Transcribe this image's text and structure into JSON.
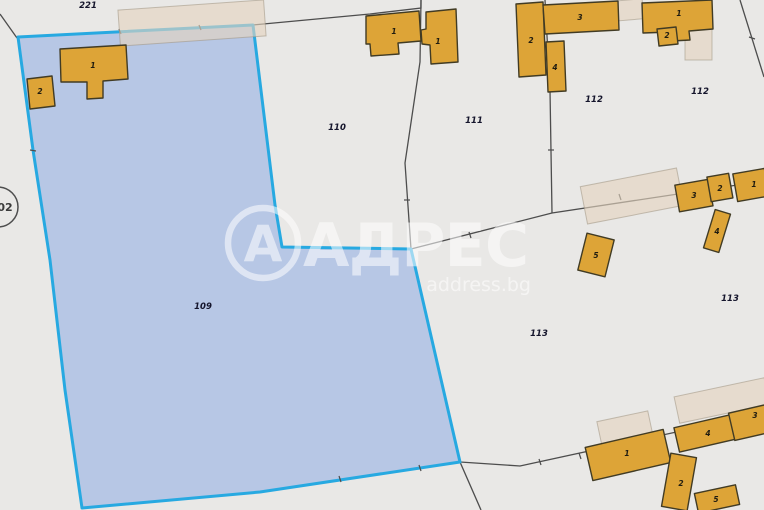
{
  "map": {
    "selected_parcel_number": "109",
    "watermark": {
      "logo_letter": "А",
      "brand": "АДРЕС",
      "domain": "address.bg"
    },
    "circled_label": {
      "text": "02"
    },
    "parcel_labels": [
      {
        "text": "221",
        "x": 88,
        "y": 8
      },
      {
        "text": "110",
        "x": 337,
        "y": 130
      },
      {
        "text": "111",
        "x": 474,
        "y": 123
      },
      {
        "text": "112",
        "x": 594,
        "y": 102
      },
      {
        "text": "112",
        "x": 700,
        "y": 94
      },
      {
        "text": "109",
        "x": 203,
        "y": 309
      },
      {
        "text": "113",
        "x": 539,
        "y": 336
      },
      {
        "text": "113",
        "x": 730,
        "y": 301
      }
    ],
    "building_labels": [
      {
        "text": "1",
        "x": 93,
        "y": 68
      },
      {
        "text": "2",
        "x": 40,
        "y": 94
      },
      {
        "text": "1",
        "x": 394,
        "y": 34
      },
      {
        "text": "1",
        "x": 438,
        "y": 44
      },
      {
        "text": "2",
        "x": 531,
        "y": 43
      },
      {
        "text": "3",
        "x": 580,
        "y": 20
      },
      {
        "text": "4",
        "x": 555,
        "y": 70
      },
      {
        "text": "1",
        "x": 679,
        "y": 16
      },
      {
        "text": "2",
        "x": 667,
        "y": 38
      },
      {
        "text": "3",
        "x": 694,
        "y": 198
      },
      {
        "text": "2",
        "x": 720,
        "y": 191
      },
      {
        "text": "1",
        "x": 754,
        "y": 187
      },
      {
        "text": "4",
        "x": 717,
        "y": 234
      },
      {
        "text": "5",
        "x": 596,
        "y": 258
      },
      {
        "text": "1",
        "x": 627,
        "y": 456
      },
      {
        "text": "4",
        "x": 708,
        "y": 436
      },
      {
        "text": "3",
        "x": 755,
        "y": 418
      },
      {
        "text": "2",
        "x": 681,
        "y": 486
      },
      {
        "text": "5",
        "x": 716,
        "y": 502
      }
    ],
    "colors": {
      "background": "#e9e8e6",
      "selected_parcel_fill": "#b7c7e5",
      "selected_parcel_border": "#27a9e1",
      "building_fill": "#dda437",
      "building_border": "#413b24",
      "parcel_boundary": "#4d4d4d",
      "ghost_building_fill": "#e3d3be",
      "watermark_color": "#ffffff"
    }
  }
}
